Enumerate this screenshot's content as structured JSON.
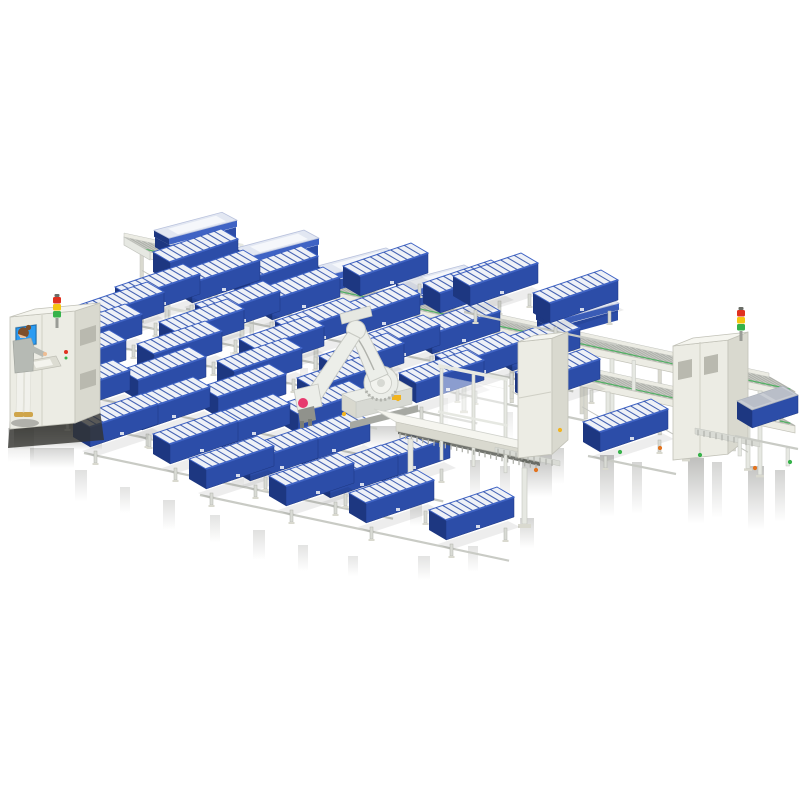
{
  "meta": {
    "title": "3D isometric render of an automated battery module assembly line with six-axis robot, operator HMI station, elevated roller conveyor and rows of blue cell-tray modules",
    "canvas": {
      "w": 800,
      "h": 800
    }
  },
  "colors": {
    "background": "#ffffff",
    "module_blue_front": "#2c4da8",
    "module_blue_dark": "#1d3781",
    "module_blue_mid": "#3f63c4",
    "cell_top_white": "#eef1f7",
    "lid_top": "#e2e7f2",
    "lid_panel": "#f5f7fb",
    "gray_lid": "#c9cdd4",
    "gray_lid_panel": "#b9bec8",
    "machine_front": "#ecece4",
    "machine_top": "#f5f5ef",
    "machine_side": "#d9d9cf",
    "machine_stroke": "#c2c2b8",
    "frame_fill": "#e6e8e2",
    "frame_stroke": "#c3c5bf",
    "roller_bed": "#d9dbd5",
    "roller_tick": "#b0b2ac",
    "green_accent": "#3faf55",
    "dark_floor": "#50524b",
    "streak": "#43443e",
    "robot_body": "#eceee9",
    "robot_stroke": "#c7c9c3",
    "robot_shade": "#d7d9d3",
    "robot_base": "#a6a8a2",
    "robot_logo_pink": "#e73a6e",
    "warning_yellow": "#f2b41f",
    "screen_blue": "#2b9cf2",
    "screen_blue_dark": "#1a6fb5",
    "signal_red": "#e0311f",
    "signal_yellow": "#f4c511",
    "signal_green": "#36b24a",
    "operator_jacket": "#b6bab4",
    "operator_pants": "#f1f1ec",
    "operator_skin": "#eebd93",
    "operator_hair": "#7d4e2a",
    "operator_shoe": "#cfa54b",
    "gripper_gray": "#90928c"
  },
  "conveyor": {
    "x_start": 150,
    "y_start": 252,
    "slope": 0.217,
    "x_end": 795,
    "deck_depth": [
      -26,
      -15
    ],
    "lower_deck_from": 520,
    "lower_deck_offset": 34,
    "upper_leg_len": 84,
    "lower_leg_len": 46,
    "lidded_module_x": [
      170,
      252,
      334,
      412,
      552
    ]
  },
  "lanes": {
    "step": [
      80,
      17
    ],
    "list": [
      {
        "x": 170,
        "y": 282,
        "n": 2
      },
      {
        "x": 360,
        "y": 296,
        "n": 2
      },
      {
        "x": 470,
        "y": 306,
        "n": 2
      },
      {
        "x": 192,
        "y": 303,
        "n": 5
      },
      {
        "x": 132,
        "y": 317,
        "n": 6
      },
      {
        "x": 96,
        "y": 335,
        "n": 5
      },
      {
        "x": 74,
        "y": 357,
        "n": 4
      },
      {
        "x": 58,
        "y": 383,
        "n": 4
      },
      {
        "x": 62,
        "y": 413,
        "n": 5
      },
      {
        "x": 90,
        "y": 447,
        "n": 4
      }
    ],
    "front_lane": {
      "x": 206,
      "y": 489,
      "n": 4
    }
  },
  "cage": {
    "posts_x": [
      165,
      208,
      250
    ]
  },
  "fence": {
    "posts_x": [
      440,
      472,
      504
    ]
  },
  "table": {
    "x1": 396,
    "y1": 431,
    "x2": 540,
    "y2": 462
  },
  "robot": {
    "red_dot": [
      303,
      403
    ]
  },
  "right_area": {
    "open_module": {
      "x": 600,
      "y": 452
    },
    "closed_module": {
      "x": 752,
      "y": 428
    }
  },
  "signal_towers": [
    {
      "x": 54,
      "y": 297
    },
    {
      "x": 738,
      "y": 310
    }
  ],
  "shadow_streaks": [
    [
      14,
      424,
      88,
      26,
      0.8
    ],
    [
      30,
      448,
      44,
      20,
      0.3
    ],
    [
      8,
      428,
      26,
      34,
      0.3
    ],
    [
      75,
      470,
      12,
      32,
      0.22
    ],
    [
      120,
      487,
      10,
      26,
      0.2
    ],
    [
      163,
      500,
      12,
      30,
      0.22
    ],
    [
      210,
      515,
      10,
      28,
      0.2
    ],
    [
      253,
      530,
      12,
      30,
      0.22
    ],
    [
      298,
      545,
      10,
      26,
      0.2
    ],
    [
      348,
      556,
      10,
      20,
      0.18
    ],
    [
      418,
      556,
      12,
      24,
      0.2
    ],
    [
      468,
      546,
      10,
      26,
      0.2
    ],
    [
      410,
      498,
      12,
      28,
      0.3
    ],
    [
      520,
      518,
      14,
      30,
      0.3
    ],
    [
      600,
      455,
      14,
      62,
      0.4
    ],
    [
      632,
      462,
      10,
      52,
      0.3
    ],
    [
      688,
      458,
      16,
      66,
      0.45
    ],
    [
      712,
      462,
      10,
      56,
      0.3
    ],
    [
      748,
      466,
      16,
      64,
      0.42
    ],
    [
      775,
      470,
      10,
      52,
      0.32
    ],
    [
      522,
      455,
      30,
      42,
      0.45
    ],
    [
      552,
      448,
      12,
      36,
      0.3
    ],
    [
      470,
      460,
      10,
      40,
      0.3
    ],
    [
      500,
      466,
      10,
      36,
      0.25
    ],
    [
      160,
      340,
      8,
      26,
      0.16
    ],
    [
      230,
      352,
      8,
      26,
      0.14
    ],
    [
      300,
      368,
      8,
      28,
      0.14
    ],
    [
      370,
      382,
      8,
      28,
      0.14
    ],
    [
      440,
      398,
      8,
      30,
      0.14
    ],
    [
      505,
      412,
      8,
      30,
      0.14
    ],
    [
      362,
      426,
      48,
      22,
      0.32
    ],
    [
      232,
      462,
      12,
      28,
      0.2
    ]
  ],
  "sensors": [
    [
      344,
      414,
      "#f2b41f"
    ],
    [
      398,
      399,
      "#f2b41f"
    ],
    [
      560,
      430,
      "#f2b41f"
    ],
    [
      620,
      452,
      "#36b24a"
    ],
    [
      660,
      448,
      "#e2731f"
    ],
    [
      700,
      455,
      "#36b24a"
    ],
    [
      755,
      468,
      "#e2731f"
    ],
    [
      790,
      462,
      "#36b24a"
    ],
    [
      536,
      470,
      "#e2731f"
    ]
  ]
}
